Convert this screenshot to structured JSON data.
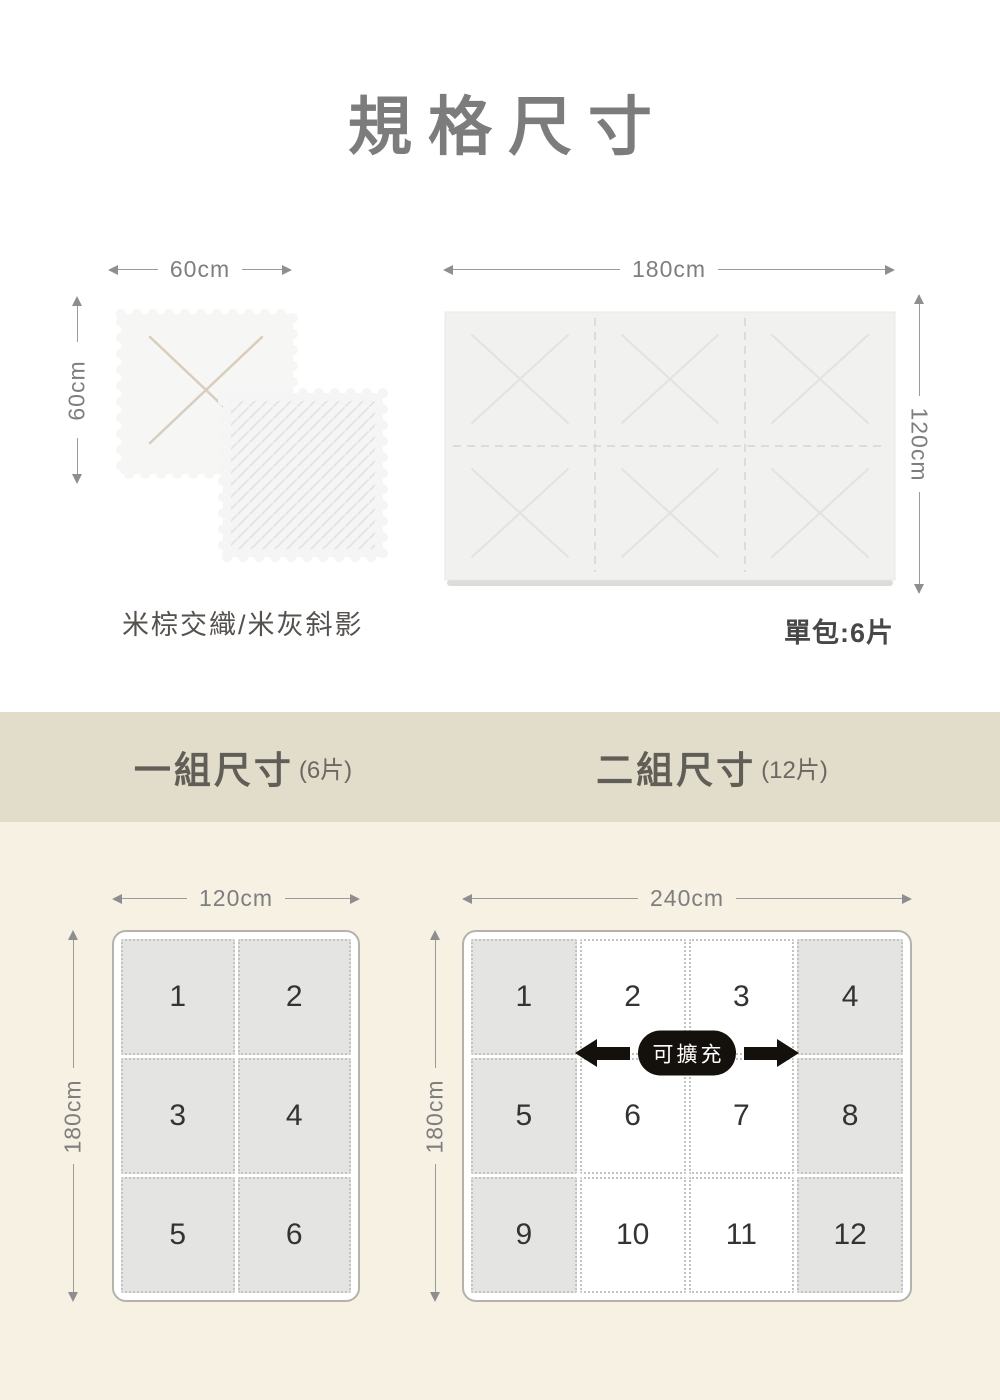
{
  "colors": {
    "band_bg": "#e2ddca",
    "bottom_bg": "#f6f1e3",
    "tile_gray": "#e4e4e2",
    "mat_light": "#f1f1ef",
    "pill_bg": "#14100c",
    "title_gray": "#7c7c7c"
  },
  "header": {
    "title": "規格尺寸"
  },
  "single_mats": {
    "width_label": "60cm",
    "height_label": "60cm",
    "pattern_label": "米棕交織/米灰斜影"
  },
  "pack_mat": {
    "width_label": "180cm",
    "height_label": "120cm",
    "pack_label": "單包:6片"
  },
  "band": {
    "set1_title": "一組尺寸",
    "set1_sub": "(6片)",
    "set2_title": "二組尺寸",
    "set2_sub": "(12片)"
  },
  "set1": {
    "width_label": "120cm",
    "height_label": "180cm",
    "tiles": [
      "1",
      "2",
      "3",
      "4",
      "5",
      "6"
    ]
  },
  "set2": {
    "width_label": "240cm",
    "height_label": "180cm",
    "expand_label": "可擴充",
    "tiles": [
      "1",
      "2",
      "3",
      "4",
      "5",
      "6",
      "7",
      "8",
      "9",
      "10",
      "11",
      "12"
    ]
  }
}
